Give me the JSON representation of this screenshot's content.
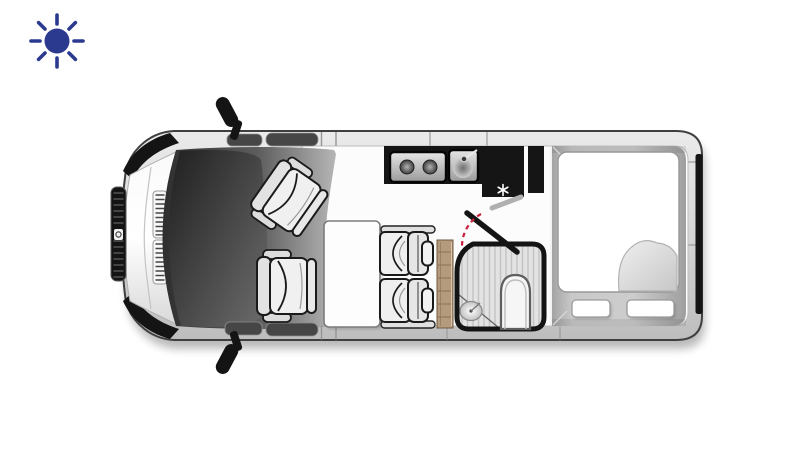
{
  "page": {
    "background_color": "#ffffff"
  },
  "brand": {
    "icon": "sun-icon",
    "color": "#2b3a8f"
  },
  "floorplan": {
    "subject": "campervan-floor-plan-top-view",
    "orientation": "vehicle-front-at-left",
    "colors": {
      "body_outline": "#3f3f3f",
      "dark_trim": "#141414",
      "kitchen_counter": "#151515",
      "wood": "#b59b7d",
      "door_swing_red": "#c81e3c",
      "floor": "#fcfcfc",
      "shower_floor": "#e3e3e3",
      "mattress": "#ffffff",
      "seat_outline": "#1a1a1a"
    },
    "icons": {
      "fridge": "snowflake-icon",
      "hob": "two-burner-hob",
      "sink": "kitchen-sink-with-faucet"
    },
    "areas": {
      "cab": {
        "label": "driver-cab",
        "items": [
          "driver-seat",
          "swiveled-passenger-seat",
          "windshield",
          "side-mirrors"
        ]
      },
      "dinette": {
        "label": "dinette",
        "items": [
          "table",
          "two-seat-bench"
        ]
      },
      "kitchen": {
        "label": "kitchenette",
        "items": [
          "two-burner-hob",
          "sink",
          "refrigerator",
          "tall-cabinet"
        ]
      },
      "bathroom": {
        "label": "wet-bath",
        "items": [
          "shower-tray",
          "toilet",
          "corner-washbasin",
          "swing-door"
        ]
      },
      "bedroom": {
        "label": "rear-bedroom",
        "items": [
          "double-mattress",
          "folded-duvet",
          "seat-cushion-left",
          "seat-cushion-right"
        ]
      },
      "storage": {
        "label": "wardrobe-unit"
      }
    }
  }
}
